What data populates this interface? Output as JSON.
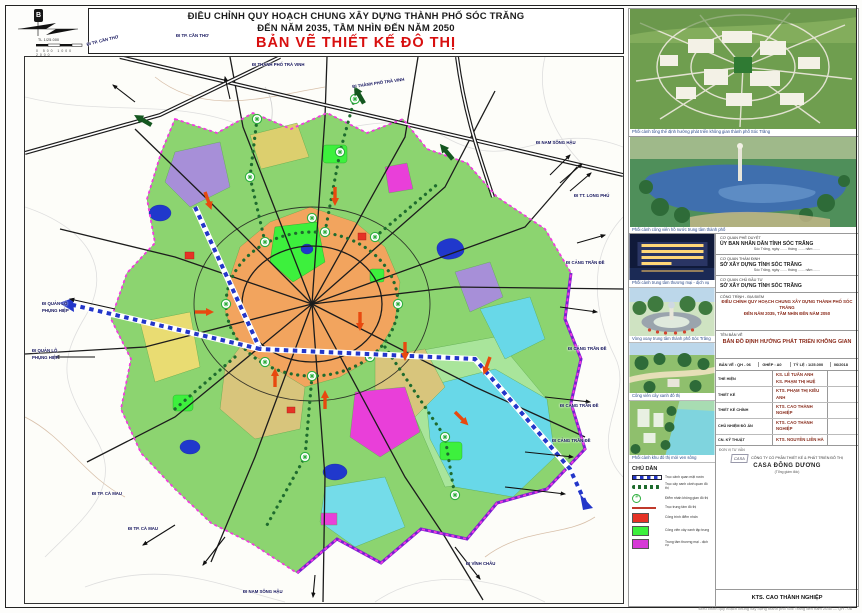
{
  "sheet": {
    "title_line1": "ĐIỀU CHỈNH QUY HOẠCH CHUNG XÂY DỰNG THÀNH PHỐ SÓC TRĂNG",
    "title_line2": "ĐẾN NĂM 2035, TẦM NHÌN ĐẾN NĂM 2050",
    "title_line3": "BẢN VẼ THIẾT KẾ ĐÔ THỊ",
    "north_label": "B",
    "scale_label": "TL 1/25.000",
    "scale_ticks": "0  500  1000  2000",
    "footer_note": "Điều chỉnh quy hoạch chung xây dựng thành phố Sóc Trăng đến năm 2035 — QH - 06"
  },
  "map": {
    "edge_labels": [
      {
        "text": "ĐI TP. CẦN THƠ",
        "x": 86,
        "y": 42,
        "r": -14
      },
      {
        "text": "ĐI TP. CẦN THƠ",
        "x": 176,
        "y": 33,
        "r": 0
      },
      {
        "text": "ĐI THÀNH PHỐ TRÀ VINH",
        "x": 252,
        "y": 62,
        "r": 0
      },
      {
        "text": "ĐI THÀNH PHỐ TRÀ VINH",
        "x": 352,
        "y": 84,
        "r": -8
      },
      {
        "text": "ĐI NAM SÔNG HẬU",
        "x": 536,
        "y": 140,
        "r": 0
      },
      {
        "text": "ĐI TT. LONG PHÚ",
        "x": 574,
        "y": 193,
        "r": 0
      },
      {
        "text": "ĐI CẢNG TRẦN ĐỀ",
        "x": 566,
        "y": 260,
        "r": 0
      },
      {
        "text": "ĐI CẢNG TRẦN ĐỀ",
        "x": 568,
        "y": 346,
        "r": 0
      },
      {
        "text": "ĐI CẢNG TRẦN ĐỀ",
        "x": 560,
        "y": 403,
        "r": 0
      },
      {
        "text": "ĐI CẢNG TRẦN ĐỀ",
        "x": 552,
        "y": 438,
        "r": 0
      },
      {
        "text": "ĐI VĨNH CHÂU",
        "x": 466,
        "y": 561,
        "r": 0
      },
      {
        "text": "ĐI NAM SÔNG HẬU",
        "x": 243,
        "y": 589,
        "r": 0
      },
      {
        "text": "ĐI TP. CÀ MAU",
        "x": 92,
        "y": 491,
        "r": 0
      },
      {
        "text": "ĐI TP. CÀ MAU",
        "x": 128,
        "y": 526,
        "r": 0
      },
      {
        "text": "ĐI QUẢN LỘ",
        "x": 42,
        "y": 301,
        "r": 0
      },
      {
        "text": "PHỤNG HIỆP",
        "x": 42,
        "y": 308,
        "r": 0
      },
      {
        "text": "ĐI QUẢN LỘ",
        "x": 32,
        "y": 348,
        "r": 0
      },
      {
        "text": "PHỤNG HIỆP",
        "x": 32,
        "y": 355,
        "r": 0
      }
    ]
  },
  "sidebar": {
    "renders": [
      {
        "caption": "Phối cảnh tổng thể định hướng phát triển không gian thành phố Sóc Trăng"
      },
      {
        "caption": "Phối cảnh công viên hồ nước trung tâm thành phố"
      }
    ],
    "thumbs": [
      {
        "caption": "Phối cảnh trung tâm thương mại - dịch vụ"
      },
      {
        "caption": "Vòng xoay trung tâm thành phố Sóc Trăng"
      },
      {
        "caption": "Công viên cây xanh đô thị"
      },
      {
        "caption": "Phối cảnh khu đô thị mới ven sông"
      }
    ],
    "approvals": [
      {
        "heading": "CƠ QUAN PHÊ DUYỆT",
        "name": "ỦY BAN NHÂN DÂN TỈNH SÓC TRĂNG",
        "date_line": "Sóc Trăng, ngày ....... tháng ....... năm ......."
      },
      {
        "heading": "CƠ QUAN THẨM ĐỊNH",
        "name": "SỞ XÂY DỰNG TỈNH SÓC TRĂNG",
        "date_line": "Sóc Trăng, ngày ....... tháng ....... năm ......."
      },
      {
        "heading": "CƠ QUAN CHỦ ĐẦU TƯ",
        "name": "SỞ XÂY DỰNG TỈNH SÓC TRĂNG",
        "date_line": ""
      }
    ],
    "project": {
      "heading": "CÔNG TRÌNH - ĐỊA ĐIỂM",
      "line1": "ĐIỀU CHỈNH QUY HOẠCH CHUNG XÂY DỰNG THÀNH PHỐ SÓC TRĂNG",
      "line2": "ĐẾN NĂM 2035, TẦM NHÌN ĐẾN NĂM 2050"
    },
    "titleblock": {
      "drawing_name_label": "TÊN BẢN VẼ",
      "drawing_name": "BẢN ĐỒ ĐỊNH HƯỚNG PHÁT TRIỂN KHÔNG GIAN",
      "sheet_no": "BẢN VẼ : QH - 06",
      "paper": "GHÉP : A0",
      "scale": "TỶ LỆ : 1/25.000",
      "date": "06/2018",
      "staff": [
        {
          "role": "THỂ HIỆN",
          "name1": "KS. LÊ TUẤN ANH",
          "name2": "KS. PHẠM THỊ HUỆ"
        },
        {
          "role": "THIẾT KẾ",
          "name1": "KTS. PHẠM THỊ KIỀU ANH",
          "name2": ""
        },
        {
          "role": "THIẾT KẾ CHÍNH",
          "name1": "KTS. CAO THÀNH NGHIỆP",
          "name2": ""
        },
        {
          "role": "CHỦ NHIỆM ĐỒ ÁN",
          "name1": "KTS. CAO THÀNH NGHIỆP",
          "name2": ""
        },
        {
          "role": "CN. KỸ THUẬT",
          "name1": "KTS. NGUYỄN LIÊN HÀ",
          "name2": ""
        }
      ],
      "company_label": "ĐƠN VỊ TƯ VẤN",
      "company_logo": "CASA",
      "company_line1": "CÔNG TY CỔ PHẦN THIẾT KẾ & PHÁT TRIỂN ĐÔ THỊ",
      "company_line2": "CASA ĐÔNG DƯƠNG",
      "company_sub": "(Tổng giám đốc)",
      "signature": "KTS. CAO THÀNH NGHIỆP"
    },
    "legend": {
      "title": "CHÚ DẪN",
      "items": [
        {
          "symbol": "water-axis",
          "color": "#2336c9",
          "label": "Trục cảnh quan mặt nước"
        },
        {
          "symbol": "green-axis",
          "color": "#1e6b2e",
          "label": "Trục cây xanh cảnh quan đô thị"
        },
        {
          "symbol": "node",
          "color": "#2faf3e",
          "label": "Điểm nhấn không gian đô thị"
        },
        {
          "symbol": "red-axis",
          "color": "#c0392b",
          "label": "Trục trung tâm đô thị"
        },
        {
          "symbol": "swatch",
          "color": "#e63226",
          "label": "Công trình điểm nhấn"
        },
        {
          "symbol": "swatch",
          "color": "#3df03d",
          "label": "Công viên cây xanh tập trung"
        },
        {
          "symbol": "swatch",
          "color": "#d63ad6",
          "label": "Trung tâm thương mại - dịch vụ"
        }
      ]
    }
  }
}
